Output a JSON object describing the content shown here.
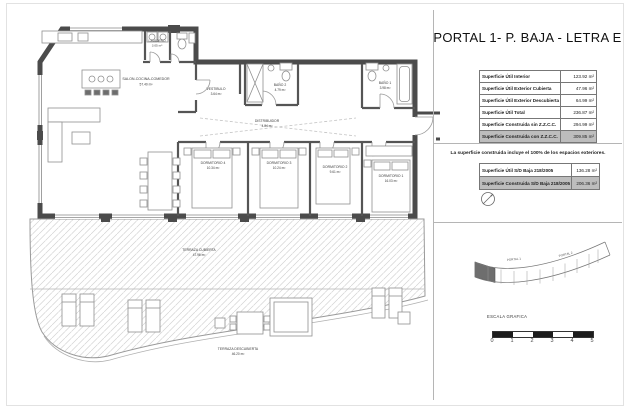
{
  "page": {
    "title": "PORTAL 1- P. BAJA - LETRA E",
    "note": "La superficie construida incluye el 100% de los espacios exteriores."
  },
  "colors": {
    "wall": "#4b4b4b",
    "highlight_row": "#bdbdbd"
  },
  "summary_table": {
    "rows": [
      {
        "label": "Superficie Útil Interior",
        "value": "123.92 m²"
      },
      {
        "label": "Superficie Útil Exterior Cubierta",
        "value": "47.96 m²"
      },
      {
        "label": "Superficie Útil Exterior Descubierta",
        "value": "64.99 m²"
      },
      {
        "label": "Superficie Útil Total",
        "value": "236.87 m²"
      },
      {
        "label": "Superficie Construida sin Z.Z.C.C.",
        "value": "294.99 m²"
      },
      {
        "label": "Superficie Construida con Z.Z.C.C.",
        "value": "309.85 m²"
      }
    ]
  },
  "decree_table": {
    "rows": [
      {
        "label": "Superficie Útil S/D Baja 218/2005",
        "value": "136.28 m²"
      },
      {
        "label": "Superficie Construida S/D Baja 218/2005",
        "value": "206.36 m²"
      }
    ]
  },
  "plan": {
    "rooms": [
      {
        "name": "SALON-COCINA-COMEDOR",
        "area": "57.40 m²"
      },
      {
        "name": "LAVADERO",
        "area": "3.05 m²"
      },
      {
        "name": "VESTIBULO",
        "area": "3.64 m²"
      },
      {
        "name": "BAÑO 2",
        "area": "4.79 m²"
      },
      {
        "name": "DISTRIBUIDOR",
        "area": "4.84 m²"
      },
      {
        "name": "BAÑO 1",
        "area": "3.98 m²"
      },
      {
        "name": "DORMITORIO 4",
        "area": "10.34 m²"
      },
      {
        "name": "DORMITORIO 3",
        "area": "10.24 m²"
      },
      {
        "name": "DORMITORIO 2",
        "area": "9.61 m²"
      },
      {
        "name": "DORMITORIO 1",
        "area": "16.03 m²"
      },
      {
        "name": "TERRAZA CUBIERTA",
        "area": "47.96 m²"
      },
      {
        "name": "TERRAZA DESCUBIERTA",
        "area": "46.20 m²"
      }
    ]
  },
  "site_key": {
    "labels": [
      "PORTAL 1",
      "PORTAL 2"
    ]
  },
  "scale_bar": {
    "caption": "ESCALA GRAFICA",
    "ticks": [
      "0",
      "1",
      "2",
      "3",
      "4",
      "5"
    ]
  }
}
